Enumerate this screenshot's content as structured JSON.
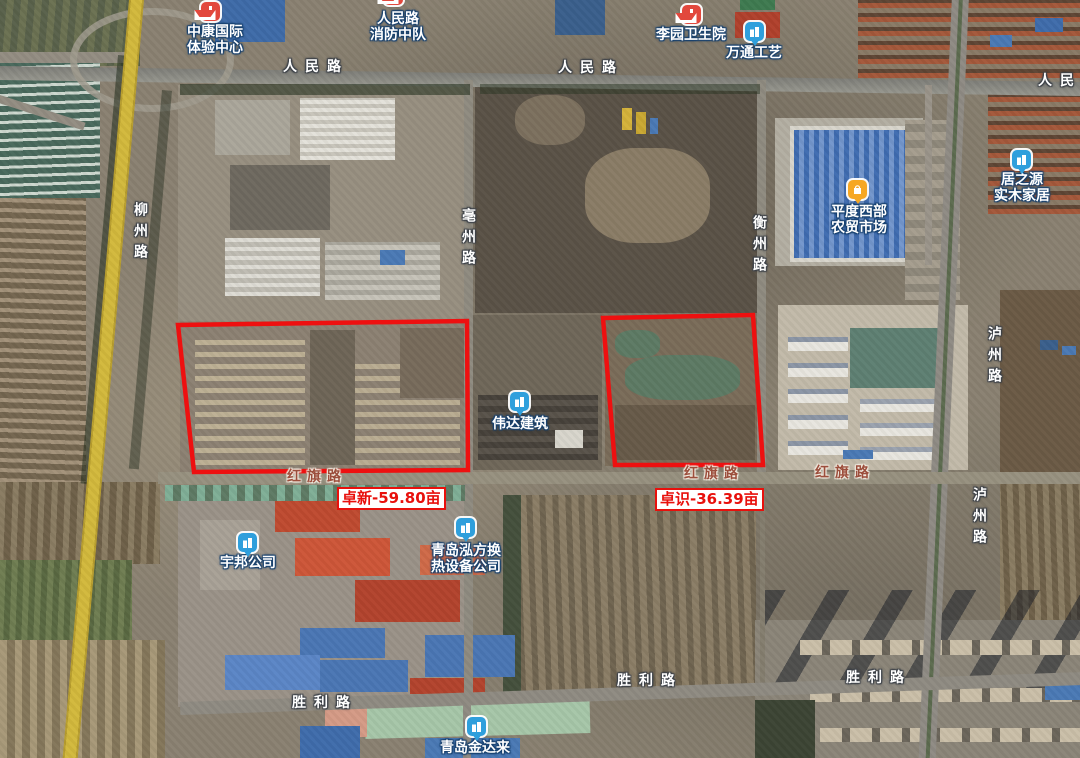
{
  "map_type": "satellite",
  "colors": {
    "parcel_outline": "#ee1010",
    "annotation_red": "#e8100c",
    "marker_red": "#e2483d",
    "marker_blue": "#2f9fdc",
    "marker_orange": "#f6a723",
    "road_label_fill": "#ffffff",
    "hongqi_label_fill": "#9c4e3c",
    "highway_yellow": "#d2b93c"
  },
  "road_labels": [
    {
      "text": "人民路"
    },
    {
      "text": "人民路"
    },
    {
      "text": "人民路"
    },
    {
      "text": "柳州路"
    },
    {
      "text": "亳州路"
    },
    {
      "text": "衡州路"
    },
    {
      "text": "泸州路"
    },
    {
      "text": "泸州路"
    },
    {
      "text": "红旗路"
    },
    {
      "text": "红旗路"
    },
    {
      "text": "红旗路"
    },
    {
      "text": "胜利路"
    },
    {
      "text": "胜利路"
    },
    {
      "text": "胜利路"
    }
  ],
  "pois": [
    {
      "name": "中康国际体验中心",
      "marker": "hospital-red",
      "line1": "中康国际",
      "line2": "体验中心"
    },
    {
      "name": "人民路消防中队",
      "marker": "hospital-red",
      "line1": "人民路",
      "line2": "消防中队"
    },
    {
      "name": "李园卫生院",
      "marker": "hospital-red",
      "line1": "李园卫生院"
    },
    {
      "name": "万通工艺",
      "marker": "building-blue",
      "line1": "万通工艺"
    },
    {
      "name": "居之源实木家居",
      "marker": "building-blue",
      "line1": "居之源",
      "line2": "实木家居"
    },
    {
      "name": "平度西部农贸市场",
      "marker": "market-orange",
      "line1": "平度西部",
      "line2": "农贸市场"
    },
    {
      "name": "伟达建筑",
      "marker": "building-blue",
      "line1": "伟达建筑"
    },
    {
      "name": "宇邦公司",
      "marker": "building-blue",
      "line1": "宇邦公司"
    },
    {
      "name": "青岛泓方换热设备公司",
      "marker": "building-blue",
      "line1": "青岛泓方换",
      "line2": "热设备公司"
    },
    {
      "name": "青岛金达来",
      "marker": "building-blue",
      "line1": "青岛金达来"
    }
  ],
  "parcels": [
    {
      "name": "卓新",
      "area_mu": "59.80",
      "label": "卓新-59.80亩",
      "points": "178,325 467,321 468,470 194,472"
    },
    {
      "name": "卓识",
      "area_mu": "36.39",
      "label": "卓识-36.39亩",
      "points": "603,318 753,315 763,465 615,465"
    }
  ]
}
